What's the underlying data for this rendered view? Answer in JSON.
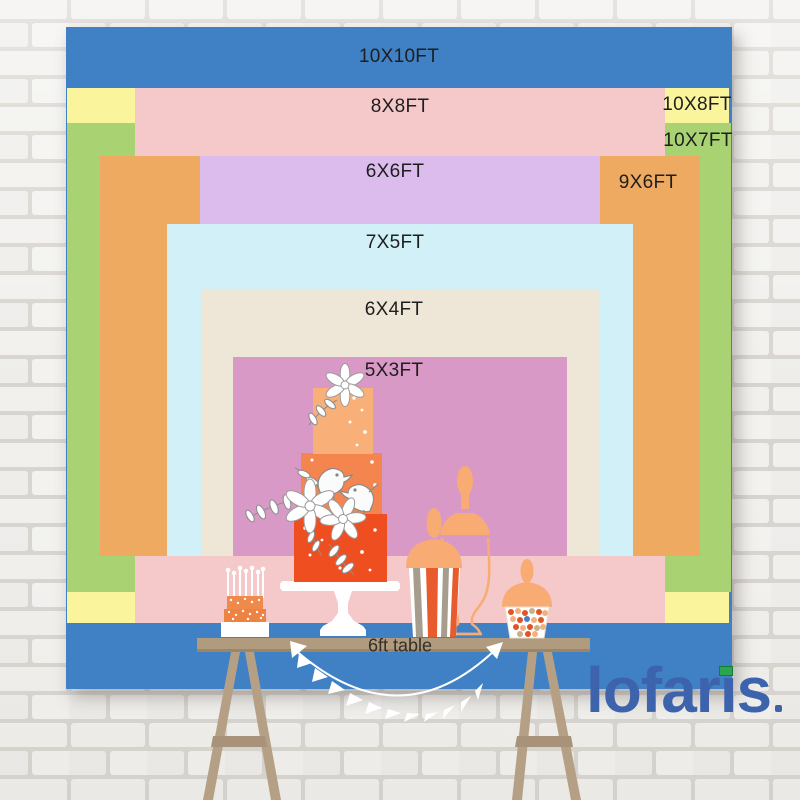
{
  "scene": {
    "description": "Lofaris backdrop size comparison chart hung on a white brick wall with an illustrated dessert table in front",
    "wall_color": "#edecea"
  },
  "backdrop": {
    "label_color": "#1e1e1e",
    "sizes": [
      {
        "label": "10X10FT",
        "color": "#4080c4"
      },
      {
        "label": "10X8FT",
        "color": "#faf59d"
      },
      {
        "label": "10X7FT",
        "color": "#a9d273"
      },
      {
        "label": "8X8FT",
        "color": "#f5c8ca"
      },
      {
        "label": "9X6FT",
        "color": "#eeaa60"
      },
      {
        "label": "6X6FT",
        "color": "#dbbcec"
      },
      {
        "label": "7X5FT",
        "color": "#d1f0f8"
      },
      {
        "label": "6X4FT",
        "color": "#eee7d8"
      },
      {
        "label": "5X3FT",
        "color": "#d999c7"
      }
    ]
  },
  "table": {
    "label": "6ft table",
    "top_color": "#b19b7f",
    "leg_color": "#b5a085"
  },
  "desserts": {
    "tiered_cake_colors": [
      "#f9b078",
      "#f5854e",
      "#ee4e20"
    ],
    "jar_color": "#f8ab72",
    "mini_cake_color": "#ef8a4a"
  },
  "brand": {
    "name": "lofaris",
    "name_pre": "lofar",
    "name_i_dotless": "ı",
    "name_post": "s",
    "color": "#3e63ad",
    "accent_green": "#2da44e"
  }
}
